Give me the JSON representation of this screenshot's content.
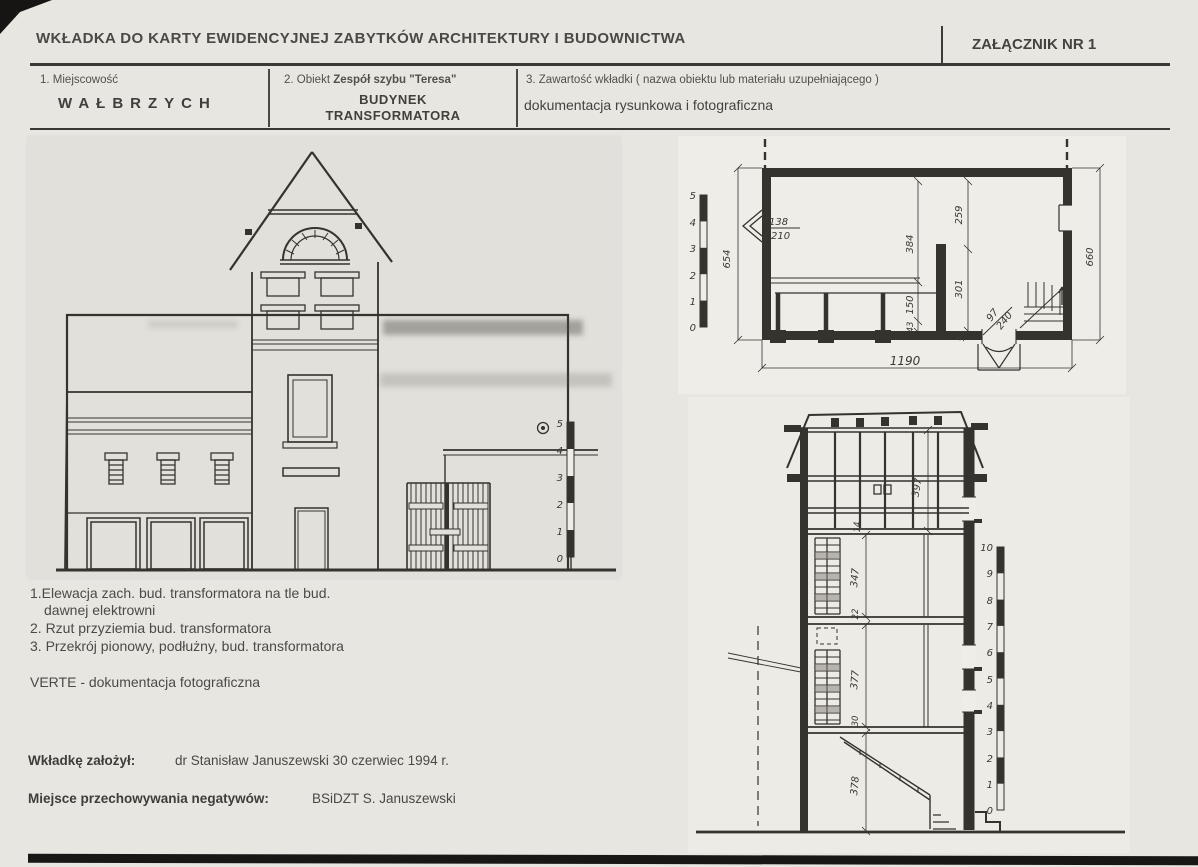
{
  "header": {
    "title": "WKŁADKA DO KARTY EWIDENCYJNEJ ZABYTKÓW ARCHITEKTURY I BUDOWNICTWA",
    "attachment": "ZAŁĄCZNIK NR  1"
  },
  "fields": {
    "f1_label": "1. Miejscowość",
    "f1_value": "WAŁBRZYCH",
    "f2_label_prefix": "2. Obiekt ",
    "f2_label_name": "Zespół szybu \"Teresa\"",
    "f2_value_line1": "BUDYNEK",
    "f2_value_line2": "TRANSFORMATORA",
    "f3_label": "3. Zawartość wkładki ( nazwa obiektu lub materiału uzupełniającego )",
    "f3_value": "dokumentacja rysunkowa i fotograficzna"
  },
  "captions": {
    "item1a": "1.Elewacja  zach. bud. transformatora na tle bud.",
    "item1b": "dawnej elektrowni",
    "item2": "2. Rzut przyziemia bud. transformatora",
    "item3": "3. Przekrój pionowy, podłużny, bud. transformatora",
    "verte": "VERTE - dokumentacja fotograficzna"
  },
  "footer": {
    "founder_label": "Wkładkę założył:",
    "founder_value": "dr  Stanisław Januszewski 30 czerwiec 1994 r.",
    "negatives_label": "Miejsce przechowywania negatywów:",
    "negatives_value": "BSiDZT S. Januszewski"
  },
  "plan": {
    "dims": {
      "left": "654",
      "right": "660",
      "bottom": "1190",
      "w1": "138",
      "w2": "210",
      "hall": "384",
      "room_top": "259",
      "room_bottom": "301",
      "lower": "150",
      "small": "43",
      "wall": "56",
      "door_w": "97",
      "door_h": "240"
    },
    "scale": [
      "5",
      "4",
      "3",
      "2",
      "1",
      "0"
    ]
  },
  "section": {
    "dims": {
      "roof": "397",
      "attic": "14",
      "mid": "347",
      "floor2": "22",
      "low": "377",
      "floor3": "30",
      "ground": "378"
    },
    "scale": [
      "10",
      "9",
      "8",
      "7",
      "6",
      "5",
      "4",
      "3",
      "2",
      "1",
      "0"
    ]
  },
  "elevation": {
    "scale": [
      "5",
      "4",
      "3",
      "2",
      "1",
      "0"
    ]
  }
}
